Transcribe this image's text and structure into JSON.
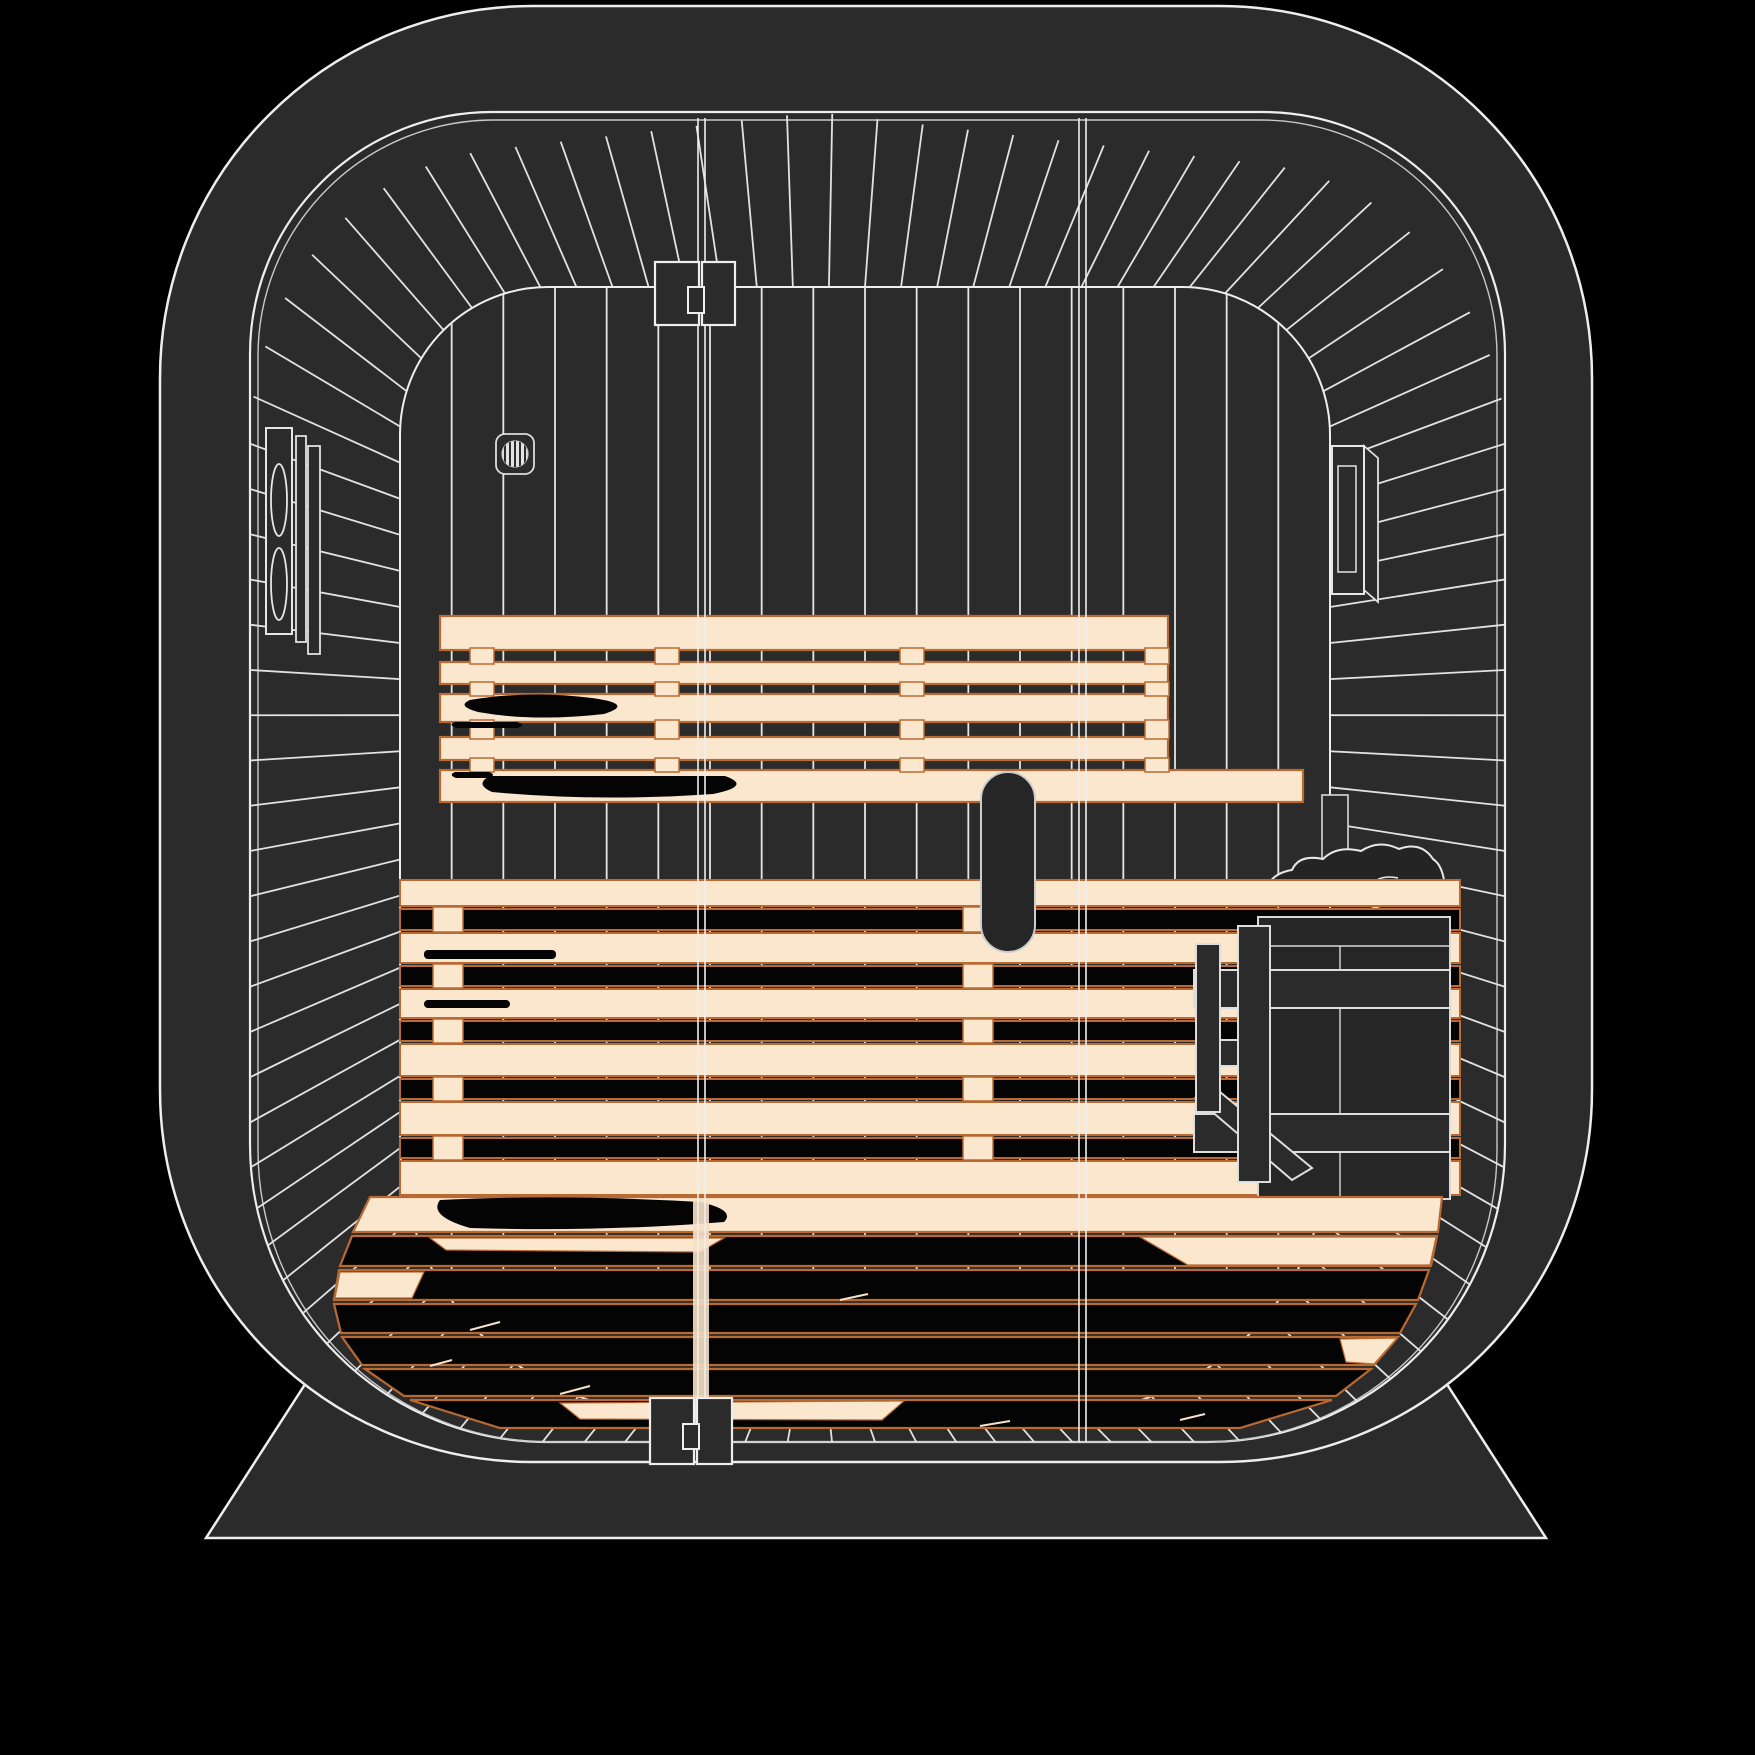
{
  "scene": {
    "type": "vector-illustration",
    "subject": "sauna-interior-front-cutaway",
    "viewBox": "0 0 1755 1755"
  },
  "palette": {
    "background": "#000000",
    "shell": "#2b2b2b",
    "line": "#eeeeee",
    "lineSoft": "#c9c9c9",
    "wood": "#fbe7ce",
    "woodEdge": "#b96a32",
    "grain": "#040404",
    "metal": "#262626",
    "ventFace": "#e3e3e3",
    "glow": "#f6dfc4",
    "tick": "#f7e3c8"
  },
  "geometry": {
    "body": {
      "x": 160,
      "y": 6,
      "w": 1432,
      "h": 1456,
      "r": 372
    },
    "base": [
      [
        340,
        1330
      ],
      [
        1412,
        1330
      ],
      [
        1546,
        1538
      ],
      [
        206,
        1538
      ]
    ],
    "opening": {
      "x": 250,
      "y": 112,
      "w": 1255,
      "h": 1330,
      "rt": 242,
      "rb": 298
    },
    "opening2": {
      "x": 258,
      "y": 120,
      "w": 1239,
      "h": 1322,
      "rt": 236,
      "rb": 292
    },
    "inner": {
      "x": 400,
      "y": 287,
      "w": 930,
      "h": 1126,
      "rt": 148,
      "rb": 272
    },
    "radial": {
      "count": 104,
      "skew": 86,
      "band": 150,
      "width": 1.8
    },
    "backSlats": {
      "n": 17,
      "x1": 400,
      "x2": 1330,
      "y1": 278,
      "y2": 1270,
      "width": 1.8
    },
    "seams": {
      "xs": [
        698,
        705,
        1079,
        1086
      ],
      "y1": 118,
      "y2": 1446,
      "glow": {
        "x": 693,
        "y": 1199,
        "w": 16,
        "h": 236
      }
    },
    "vent": {
      "box": [
        496,
        434,
        38,
        40,
        9
      ],
      "circle": [
        515,
        454,
        13
      ],
      "lines": 5
    },
    "speaker": {
      "face": [
        266,
        428,
        26,
        206
      ],
      "ellipses": [
        [
          279,
          500,
          8,
          36
        ],
        [
          279,
          584,
          8,
          36
        ]
      ],
      "bars": [
        [
          296,
          436,
          10,
          206
        ],
        [
          308,
          446,
          12,
          208
        ]
      ]
    },
    "fixture": {
      "face": [
        1332,
        446,
        32,
        148
      ],
      "side": [
        [
          1364,
          446
        ],
        [
          1378,
          458
        ],
        [
          1378,
          602
        ],
        [
          1364,
          590
        ]
      ],
      "inner": [
        1338,
        466,
        18,
        106
      ]
    },
    "backrest": {
      "x": 440,
      "rows": [
        [
          616,
          34,
          728
        ],
        [
          662,
          22,
          728
        ],
        [
          694,
          28,
          728
        ],
        [
          737,
          23,
          728
        ],
        [
          770,
          32,
          863
        ]
      ],
      "gaps": [
        [
          650,
          12
        ],
        [
          684,
          10
        ],
        [
          722,
          15
        ],
        [
          760,
          10
        ]
      ],
      "cleats": [
        470,
        655,
        900,
        1145
      ],
      "cleatW": 24
    },
    "seat": {
      "x": 400,
      "w": 1060,
      "rows": [
        [
          880,
          26,
          "c"
        ],
        [
          909,
          21,
          "b"
        ],
        [
          933,
          30,
          "c"
        ],
        [
          966,
          20,
          "b"
        ],
        [
          989,
          29,
          "c"
        ],
        [
          1021,
          20,
          "b"
        ],
        [
          1044,
          32,
          "c"
        ],
        [
          1079,
          20,
          "b"
        ],
        [
          1102,
          33,
          "c"
        ],
        [
          1138,
          20,
          "b"
        ],
        [
          1161,
          34,
          "c"
        ]
      ],
      "tabs": [
        433,
        963
      ],
      "tabW": 30
    },
    "heater": {
      "wallboard": [
        1322,
        795,
        26,
        110
      ],
      "rocks": "M1262,906 Q1264,874 1292,870 Q1299,854 1323,859 Q1337,845 1361,851 Q1379,839 1399,849 Q1421,841 1433,859 Q1447,868 1445,906 Z",
      "rockLines": [
        "M1301,904 Q1309,878 1337,882",
        "M1362,902 Q1370,872 1398,878"
      ],
      "body": [
        1258,
        917,
        192,
        282
      ],
      "rim": 946,
      "seamX": 1340,
      "rails": [
        [
          1194,
          970,
          256,
          38
        ],
        [
          1194,
          1114,
          256,
          38
        ]
      ],
      "posts": [
        [
          1196,
          944,
          24,
          168
        ],
        [
          1238,
          926,
          32,
          256
        ]
      ],
      "connector": [
        1196,
        1040,
        42,
        26
      ],
      "brace": [
        [
          1196,
          1098
        ],
        [
          1220,
          1092
        ],
        [
          1312,
          1168
        ],
        [
          1292,
          1180
        ]
      ],
      "screws": [
        [
          1254,
          989
        ],
        [
          1254,
          1133
        ]
      ]
    },
    "floor": {
      "rows": [
        {
          "y": 1197,
          "h": 35,
          "lt": 370,
          "rt": 1442,
          "lb": 353,
          "rb": 1438,
          "t": "c"
        },
        {
          "y": 1236,
          "h": 30,
          "lt": 352,
          "rt": 1437,
          "lb": 340,
          "rb": 1431,
          "t": "b"
        },
        {
          "y": 1270,
          "h": 30,
          "lt": 339,
          "rt": 1429,
          "lb": 334,
          "rb": 1418,
          "t": "b"
        },
        {
          "y": 1304,
          "h": 29,
          "lt": 334,
          "rt": 1416,
          "lb": 341,
          "rb": 1400,
          "t": "b"
        },
        {
          "y": 1337,
          "h": 28,
          "lt": 342,
          "rt": 1398,
          "lb": 362,
          "rb": 1374,
          "t": "b"
        },
        {
          "y": 1369,
          "h": 27,
          "lt": 365,
          "rt": 1371,
          "lb": 404,
          "rb": 1336,
          "t": "b"
        },
        {
          "y": 1400,
          "h": 28,
          "lt": 410,
          "rt": 1332,
          "lb": 500,
          "rb": 1240,
          "t": "b"
        }
      ],
      "patches": [
        [
          [
            1140,
            1237
          ],
          [
            1436,
            1237
          ],
          [
            1430,
            1265
          ],
          [
            1188,
            1265
          ]
        ],
        [
          [
            430,
            1238
          ],
          [
            724,
            1238
          ],
          [
            700,
            1252
          ],
          [
            446,
            1250
          ]
        ],
        [
          [
            340,
            1272
          ],
          [
            424,
            1272
          ],
          [
            412,
            1298
          ],
          [
            335,
            1298
          ]
        ],
        [
          [
            1340,
            1339
          ],
          [
            1397,
            1338
          ],
          [
            1374,
            1364
          ],
          [
            1346,
            1362
          ]
        ],
        [
          [
            560,
            1403
          ],
          [
            904,
            1401
          ],
          [
            882,
            1420
          ],
          [
            580,
            1419
          ]
        ]
      ],
      "ticks": [
        [
          470,
          1330,
          500,
          1322
        ],
        [
          560,
          1394,
          590,
          1386
        ],
        [
          430,
          1366,
          452,
          1360
        ],
        [
          700,
          1424,
          730,
          1418
        ],
        [
          980,
          1426,
          1010,
          1421
        ],
        [
          1180,
          1420,
          1205,
          1414
        ],
        [
          840,
          1300,
          868,
          1294
        ]
      ]
    },
    "grain": {
      "backrestBlobs": [
        "M470,700 Q530,690 592,698 Q636,704 604,714 Q534,722 478,712 Q456,706 470,700 Z",
        "M455,722 h62 q10,3 0,6 h-60 q-10,-3 -2,-6 Z",
        "M490,776 h235 q28,10 -12,18 Q595,802 492,792 Q474,784 490,776 Z",
        "M455,772 h34 q8,3 0,6 h-33 q-8,-3 -1,-6 Z"
      ],
      "seatStreaks": [
        [
          424,
          950,
          132,
          9
        ],
        [
          424,
          1000,
          86,
          8
        ]
      ],
      "floorBlob": "M440,1200 Q560,1194 700,1202 Q736,1210 724,1222 Q600,1232 470,1228 Q428,1216 440,1200 Z"
    },
    "hinges": {
      "top": {
        "r1": [
          655,
          262,
          44,
          63
        ],
        "r2": [
          702,
          262,
          33,
          63
        ],
        "tab": [
          688,
          287,
          16,
          26
        ]
      },
      "bottom": {
        "r1": [
          650,
          1398,
          44,
          66
        ],
        "r2": [
          697,
          1398,
          35,
          66
        ],
        "tab": [
          683,
          1424,
          16,
          25
        ]
      }
    },
    "handle": {
      "x": 981,
      "y": 772,
      "w": 54,
      "h": 180,
      "r": 27
    }
  }
}
